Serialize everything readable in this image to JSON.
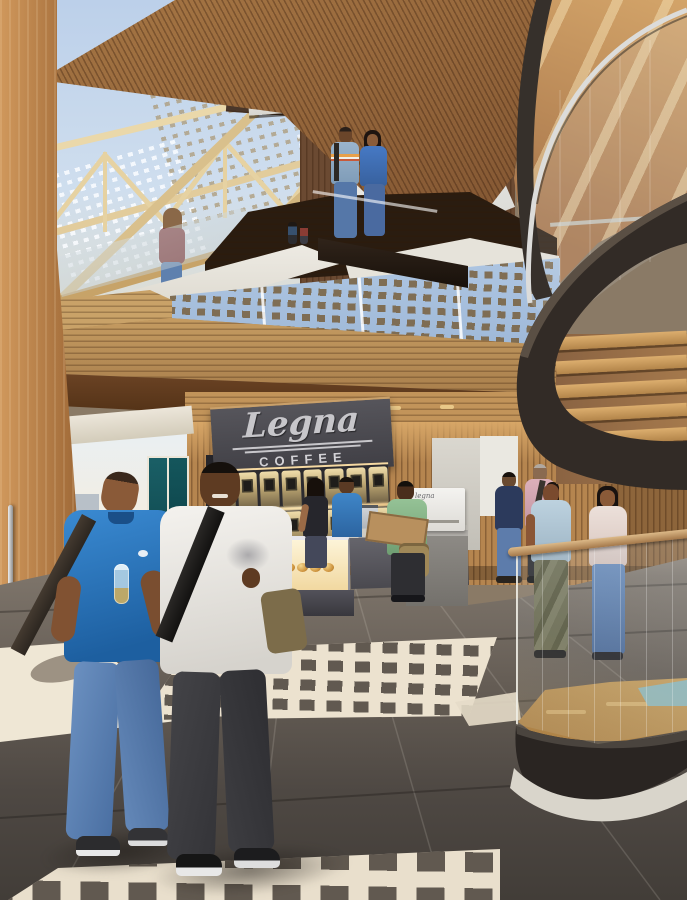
{
  "scene": {
    "type": "architectural interior rendering",
    "description": "Multi-storey timber atrium with skylight trusses, spiral staircase and coffee kiosk, people walking through"
  },
  "signage": {
    "kiosk_script": "Legna",
    "kiosk_caps": "COFFEE",
    "machine_label": "legna"
  },
  "kiosk": {
    "dispensers_per_row": 8,
    "pastry_count": 10,
    "panel_color": "#47464b",
    "logo_color": "#c7c6ca"
  },
  "structure": {
    "spiral_tread_count": 6,
    "floor_light_patch_count": 3,
    "frit_mullion_count": 3
  },
  "people": {
    "corridor_crowd_count": 7,
    "foreground": [
      "man in blue polo with shoulder strap holding bottle, blue jeans",
      "man in white long-sleeve shirt with backpack strap, dark trousers"
    ],
    "counter": [
      "barista in blue polo",
      "woman customer in black top",
      "man in green t-shirt with satchel reading menu board"
    ],
    "walking": [
      "man in navy turtleneck and jeans",
      "man in pink shirt with shoulder bag",
      "woman in light blue top and camouflage trousers",
      "woman in cream top and jeans"
    ],
    "upper_levels": [
      "couple standing at balcony rail",
      "woman crossing glass bridge",
      "two distant figures"
    ]
  },
  "palette": {
    "ceiling_wood": "#9a6a3c",
    "truss_cream": "#e6d2a2",
    "sky": "#c2d4ea",
    "mezzanine_wood": "#c19a62",
    "stair_dark": "#322b26",
    "stair_tread": "#cf9f63",
    "floor_dark": "#5a534d",
    "floor_light_patch": "#ece2cf",
    "wall_wood": "#b5854f",
    "glass_blue": "#a9c2e0",
    "teal_door": "#1a5f66"
  }
}
